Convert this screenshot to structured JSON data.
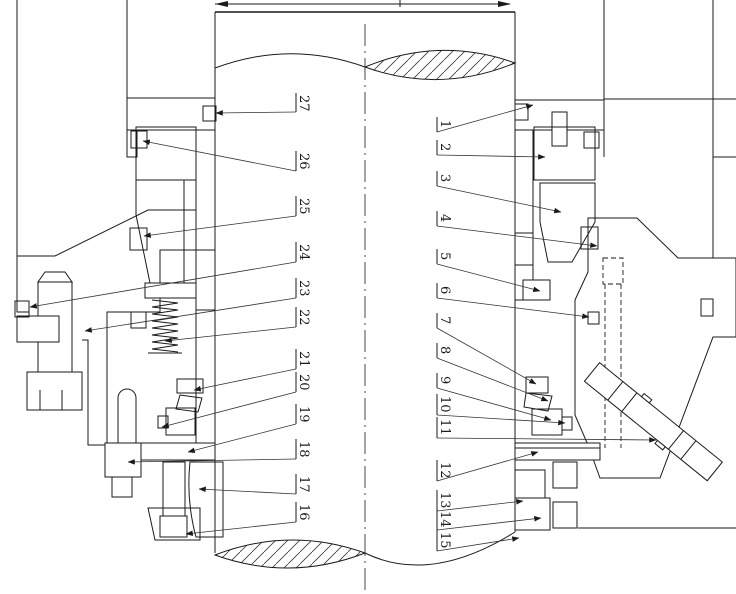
{
  "drawing": {
    "type": "technical-section-drawing",
    "subject": "mechanical shaft seal assembly, cross-section with numbered part callouts",
    "background_color": "#ffffff",
    "line_color": "#1a1a1a",
    "callouts_left": [
      "27",
      "26",
      "25",
      "24",
      "23",
      "22",
      "21",
      "20",
      "19",
      "18",
      "17",
      "16"
    ],
    "callouts_right": [
      "1",
      "2",
      "3",
      "4",
      "5",
      "6",
      "7",
      "8",
      "9",
      "10",
      "11",
      "12",
      "13",
      "14",
      "15"
    ]
  }
}
